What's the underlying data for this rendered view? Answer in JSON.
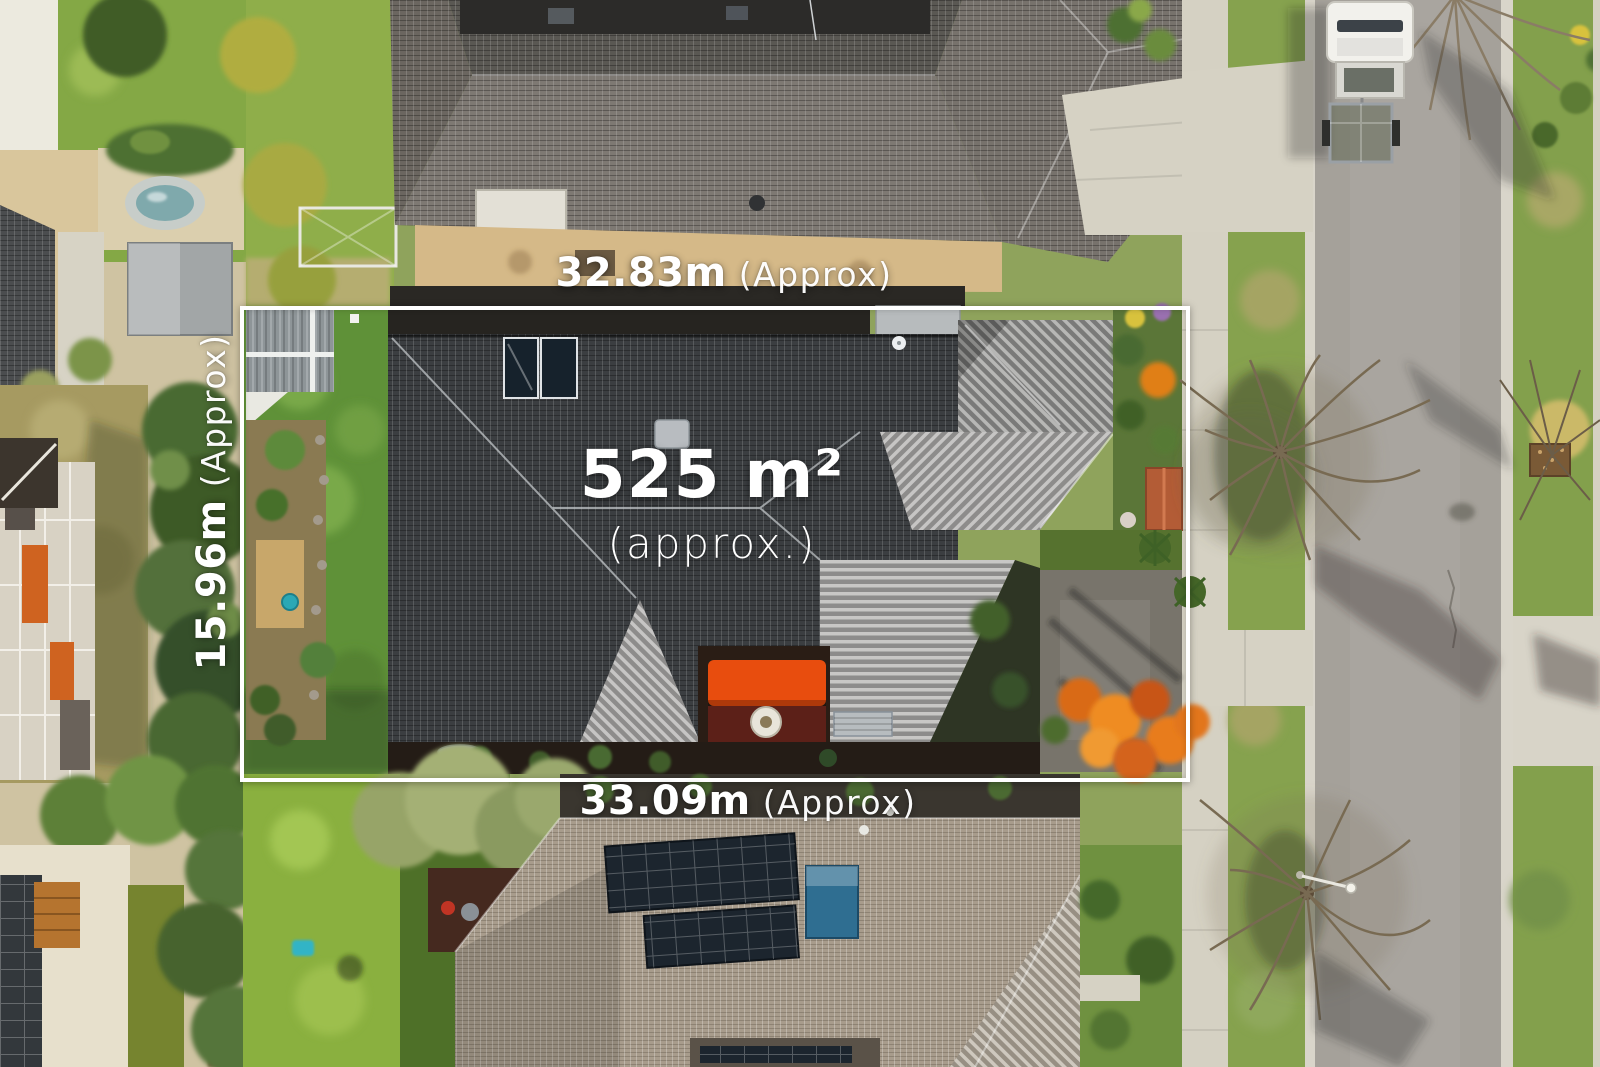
{
  "annotations": {
    "area": {
      "value": "525 m²",
      "qualifier": "(approx.)"
    },
    "width_top": {
      "value": "32.83m",
      "qualifier": "(Approx)"
    },
    "width_bottom": {
      "value": "33.09m",
      "qualifier": "(Approx)"
    },
    "depth_left": {
      "value": "15.96m",
      "qualifier": "(Approx)"
    }
  },
  "colors": {
    "annotation_text": "#ffffff",
    "boundary_line": "#ffffff",
    "subject_roof_dark": "#3b3e41",
    "subject_roof_light": "#a6a5a2",
    "neighbor_roof_top": "#7e7973",
    "neighbor_roof_bottom": "#a89c8c",
    "lawn": "#5f9138",
    "road": "#a5a19a",
    "concrete": "#d6d2c4",
    "shade_sail": "#e84d0e",
    "autumn_tree": "#e07f16",
    "solar_panel": "#1c252e",
    "pool_panel_blue": "#2f6e91"
  }
}
